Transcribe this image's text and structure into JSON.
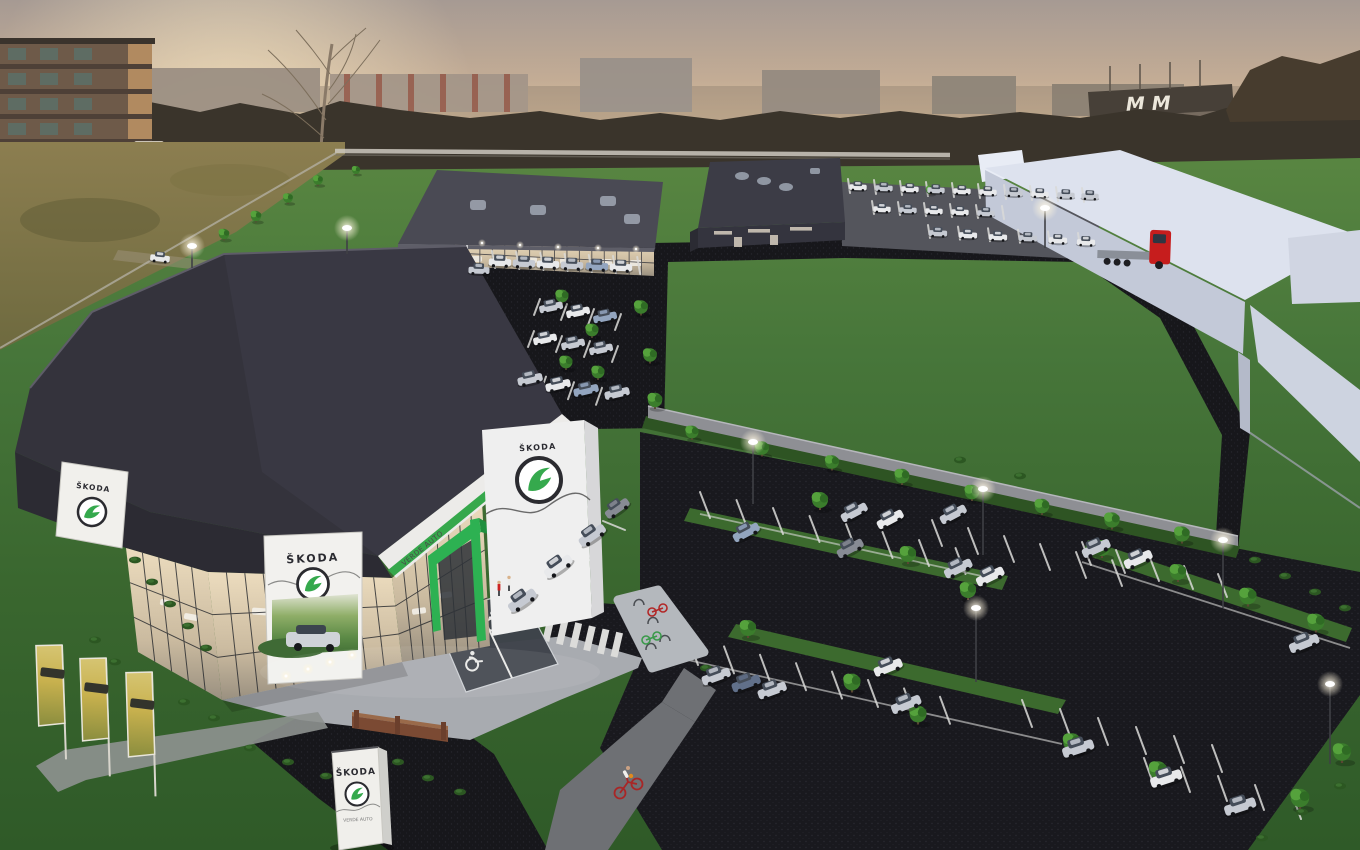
{
  "scene": {
    "billboard": {
      "brand": "ŠKODA"
    },
    "pillar_sign": {
      "brand": "ŠKODA"
    },
    "wall_sign": {
      "brand": "ŠKODA"
    },
    "fascia": {
      "dealer": "VERDE AUTO"
    },
    "totem": {
      "brand": "ŠKODA",
      "dealer": "VERDE AUTO"
    },
    "background_building_sign": {
      "text": "MM"
    }
  },
  "icons": {
    "skoda_logo": "skoda-winged-arrow-icon",
    "wheelchair": "wheelchair-marking-icon",
    "street_light": "street-light-icon"
  },
  "colors": {
    "skoda_green": "#35a94d",
    "portal_green": "#2db152",
    "stripe_green": "#36a84c",
    "roof_dark": "#34333c",
    "asphalt": "#17171b",
    "lawn": "#47763a",
    "sky_top": "#a69a93",
    "sky_horizon": "#efd9b2",
    "white_building": "#dde2ee",
    "truck_red": "#c61d1d",
    "banner_gold": "#c8b14e"
  }
}
